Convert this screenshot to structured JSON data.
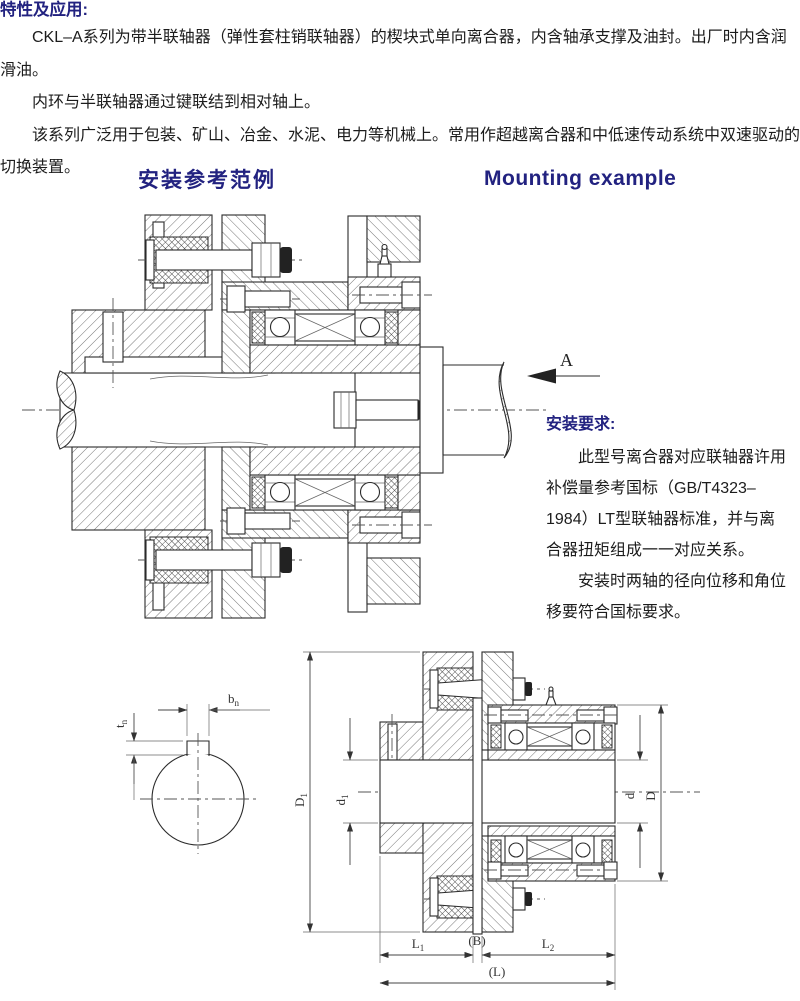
{
  "intro": {
    "title": "特性及应用:",
    "paragraphs": [
      "CKL–A系列为带半联轴器（弹性套柱销联轴器）的楔块式单向离合器，内含轴承支撑及油封。出厂时内含润滑油。",
      "内环与半联轴器通过键联结到相对轴上。",
      "该系列广泛用于包装、矿山、冶金、水泥、电力等机械上。常用作超越离合器和中低速传动系统中双速驱动的切换装置。"
    ]
  },
  "section_headings": {
    "zh": "安装参考范例",
    "en": "Mounting example"
  },
  "mounting_view": {
    "view_label": "A"
  },
  "install_requirements": {
    "title": "安装要求:",
    "paragraphs": [
      "此型号离合器对应联轴器许用补偿量参考国标（GB/T4323–1984）LT型联轴器标准，并与离合器扭矩组成一一对应关系。",
      "安装时两轴的径向位移和角位移要符合国标要求。"
    ]
  },
  "dimension_labels": {
    "b": {
      "base": "b",
      "sub": "n"
    },
    "t": {
      "base": "t",
      "sub": "n"
    },
    "D1": {
      "base": "D",
      "sub": "1"
    },
    "d1": {
      "base": "d",
      "sub": "1"
    },
    "d": {
      "base": "d",
      "sub": ""
    },
    "D": {
      "base": "D",
      "sub": ""
    },
    "L1": {
      "base": "L",
      "sub": "1"
    },
    "B": {
      "base": "(B)",
      "sub": ""
    },
    "L2": {
      "base": "L",
      "sub": "2"
    },
    "L": {
      "base": "(L)",
      "sub": ""
    }
  },
  "colors": {
    "heading": "#222280",
    "body": "#1c1c1c",
    "line": "#2b2b2b"
  }
}
